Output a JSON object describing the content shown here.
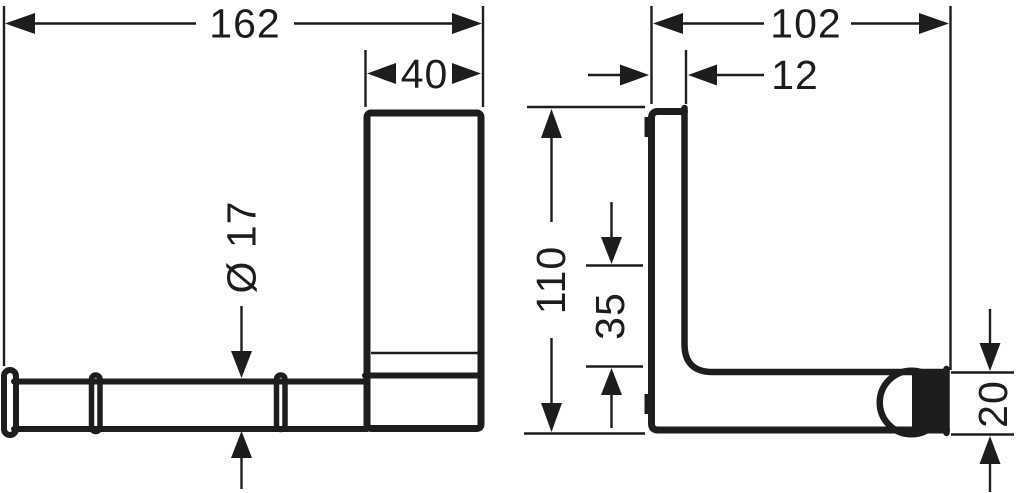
{
  "style": {
    "line_color": "#1d1d1b",
    "background": "#ffffff"
  },
  "drawing": {
    "front_view": {
      "overall_width": "162",
      "plate_width": "40",
      "bar_diameter": "Ø 17"
    },
    "side_view": {
      "overall_depth": "102",
      "plate_thickness": "12",
      "overall_height": "110",
      "bar_top_offset": "35",
      "bar_end_height": "20"
    }
  }
}
